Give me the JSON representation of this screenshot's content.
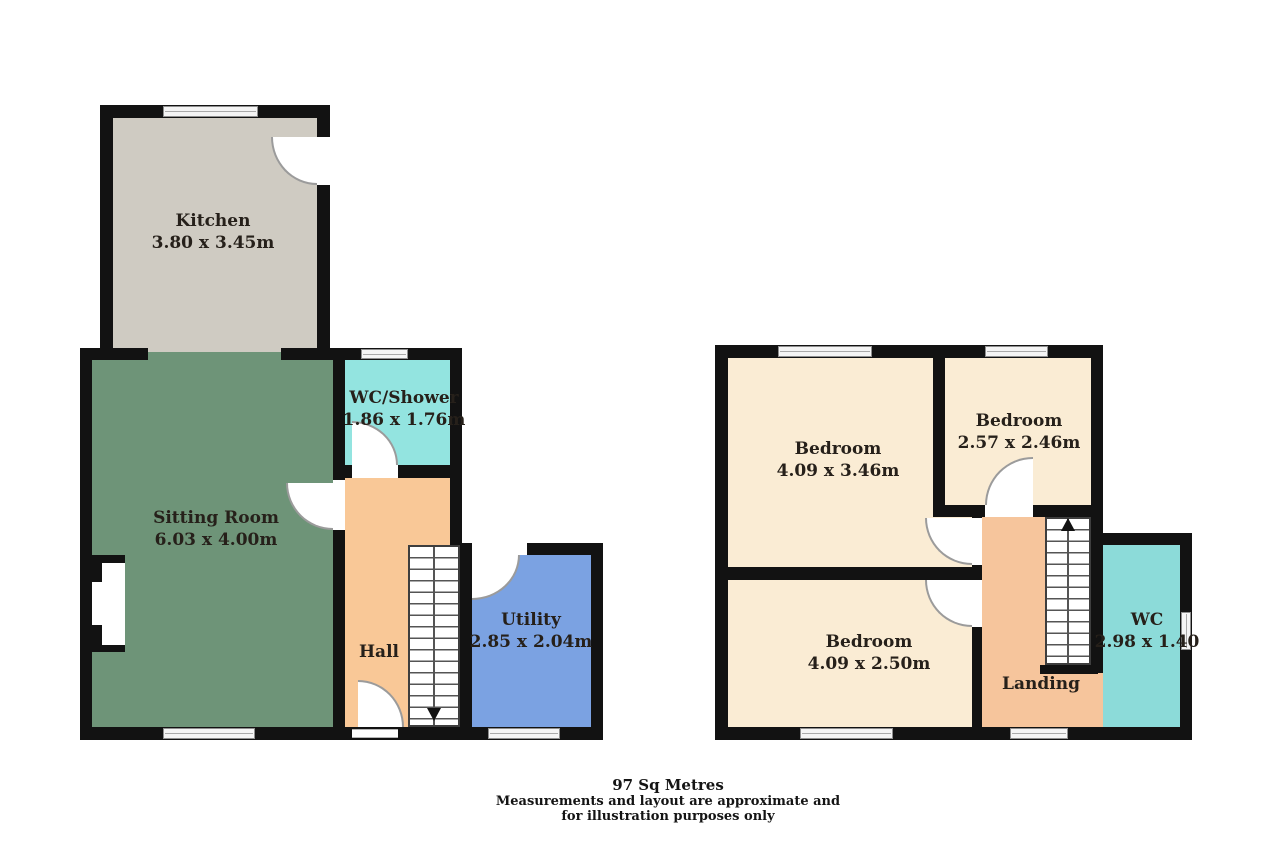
{
  "ground": {
    "rooms": [
      {
        "name": "Kitchen",
        "dims": "3.80 x 3.45m"
      },
      {
        "name": "Sitting Room",
        "dims": "6.03 x 4.00m"
      },
      {
        "name": "WC/Shower",
        "dims": "1.86 x 1.76m"
      },
      {
        "name": "Hall",
        "dims": ""
      },
      {
        "name": "Utility",
        "dims": "2.85 x 2.04m"
      }
    ]
  },
  "first": {
    "rooms": [
      {
        "name": "Bedroom",
        "dims": "4.09 x 3.46m"
      },
      {
        "name": "Bedroom",
        "dims": "2.57 x 2.46m"
      },
      {
        "name": "Bedroom",
        "dims": "4.09 x 2.50m"
      },
      {
        "name": "Landing",
        "dims": ""
      },
      {
        "name": "WC",
        "dims": "2.98 x 1.40"
      }
    ]
  },
  "footer": {
    "area": "97 Sq Metres",
    "line1": "Measurements and layout are approximate and",
    "line2": "for illustration purposes only"
  },
  "colors": {
    "wall": "#121212",
    "kitchen": "#cfcbc2",
    "sitting_room": "#6e9478",
    "wc_shower": "#93e4e0",
    "hall": "#f9c897",
    "utility": "#7ba2e2",
    "bedroom": "#faecd4",
    "landing": "#f6c59c",
    "wc": "#8cdbd9"
  }
}
